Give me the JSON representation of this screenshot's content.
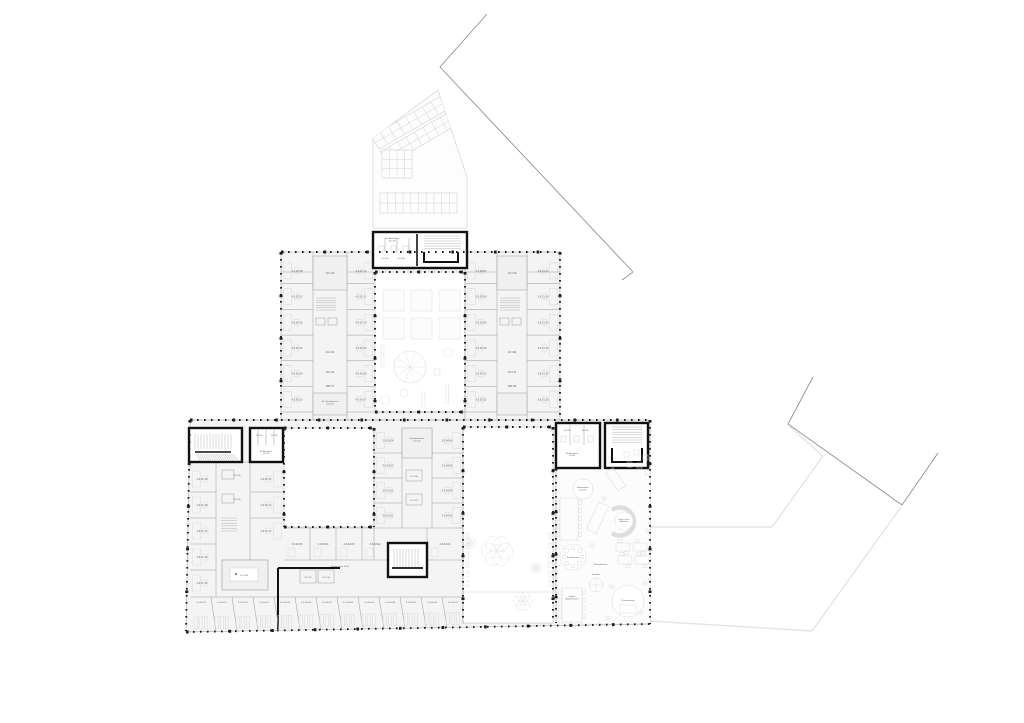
{
  "plan": {
    "colors": {
      "wall": "#9a9a9a",
      "outline": "#b5b5b5",
      "core_black": "#111111",
      "room_fill": "#f4f4f4",
      "court_fill": "#ffffff",
      "furniture": "#d9d9d9",
      "site_dark": "#8f8f8f",
      "site_light": "#e4e4e4",
      "label": "#555555"
    },
    "cores": {
      "top_room": [
        "ELT Abst.Raum",
        "10.0.03"
      ],
      "top_wc": [
        "10.0.05",
        "10.0.06"
      ],
      "nw_wc": [
        "10.2.05",
        "10.2.06"
      ],
      "nw_room": [
        "ELT Abst.Raum",
        "10.1.03"
      ],
      "e_wc": [
        "10.3.05",
        "10.3.06"
      ],
      "e_room": [
        "ELT Abst.Raum",
        "10.3.03"
      ]
    },
    "upper": {
      "west_outer": [
        "4.0.02.18",
        "4.0.02.17",
        "4.0.02.16",
        "4.0.02.15",
        "4.0.02.14",
        "4.0.02.13"
      ],
      "west_inner": [
        "4.0.03.12",
        "4.0.03.11",
        "4.0.03.10",
        "4.0.03.09",
        "4.0.03.08",
        "4.0.03.07"
      ],
      "west_core": [
        "10.1.20",
        "10.2.04",
        "10.1.21",
        "ABT 07"
      ],
      "west_core_room": [
        "Elt. Verteilerraum",
        "10.2.03"
      ],
      "east_inner": [
        "3.0.02.07",
        "3.0.02.08",
        "3.0.02.09",
        "3.0.02.10",
        "3.0.02.11",
        "3.0.02.12"
      ],
      "east_core": [
        "10.3.20",
        "10.3.04",
        "10.3.21",
        "ABT 08"
      ],
      "east_outer": [
        "3.0.01.13",
        "3.0.01.14",
        "3.0.01.15",
        "3.0.01.16",
        "3.0.01.17",
        "3.0.01.18"
      ]
    },
    "lower": {
      "west_outer": [
        "2.0.01.19",
        "2.0.01.18",
        "2.0.01.17",
        "2.0.01.16",
        "2.0.01.15"
      ],
      "west_core": [
        "10.1.05",
        "10.1.06"
      ],
      "west_inner": [
        "2.0.02.15",
        "2.0.02.14",
        "2.0.02.13"
      ],
      "staff_room": "10.1.60",
      "corridor": "Garderoben (Flur)",
      "putz": [
        "Putzmittelraum",
        "10.1.02"
      ],
      "mid_rooms": [
        "2.0.02.05",
        "2.0.02.04",
        "2.0.02.03",
        "2.0.02.02",
        "2.0.02.01"
      ],
      "center_col_a": [
        "2.0.03.04",
        "2.0.03.03",
        "2.0.03.02",
        "2.0.03.01"
      ],
      "center_core": [
        "10.1.04",
        "10.1.03"
      ],
      "center_col_b": [
        "2.0.04.06",
        "2.0.04.05",
        "2.0.04.04",
        "2.0.04.03"
      ],
      "mini_core": [
        "10.1.07",
        "10.1.08"
      ],
      "bottom_rooms": [
        "2.0.05.13",
        "2.0.05.12",
        "2.0.05.11",
        "2.0.05.10",
        "2.0.05.09",
        "2.0.05.08",
        "2.0.05.07",
        "2.0.05.06",
        "2.0.05.05",
        "2.0.05.04",
        "2.0.05.03",
        "2.0.05.02",
        "2.0.05.01"
      ],
      "commons": {
        "wardrobe": [
          "Garderoben-",
          "bereich"
        ],
        "cuddle": [
          "Kuschelecke",
          "Bibliothek"
        ],
        "project": "Projektraum",
        "bistro": "Bistrobereich",
        "tea": "Teeküche",
        "amphi": [
          "Großes",
          "Amphitheater"
        ],
        "theme": "Themenraum"
      }
    }
  }
}
